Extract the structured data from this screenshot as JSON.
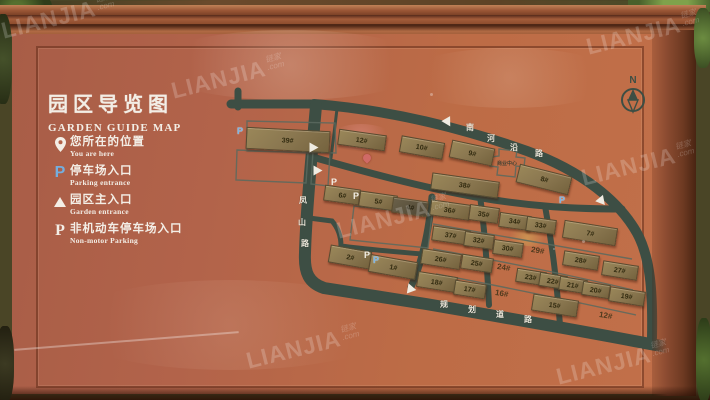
{
  "sign": {
    "title_cn": "园区导览图",
    "title_en": "GARDEN GUIDE MAP",
    "legend": [
      {
        "icon": "location-pin-icon",
        "label_cn": "您所在的位置",
        "label_en": "You are here"
      },
      {
        "icon": "parking-entrance-icon",
        "label_cn": "停车场入口",
        "label_en": "Parking entrance"
      },
      {
        "icon": "main-entrance-icon",
        "label_cn": "园区主入口",
        "label_en": "Garden entrance"
      },
      {
        "icon": "non-motor-parking-icon",
        "label_cn": "非机动车停车场入口",
        "label_en": "Non-motor Parking"
      }
    ],
    "compass": {
      "label": "N"
    }
  },
  "map": {
    "roads": [
      {
        "name": "南河沿路",
        "chars": [
          [
            466,
            122
          ],
          [
            487,
            133
          ],
          [
            510,
            142
          ],
          [
            535,
            148
          ]
        ]
      },
      {
        "name": "凤山路",
        "chars": [
          [
            299,
            195
          ],
          [
            298,
            217
          ],
          [
            301,
            238
          ]
        ]
      },
      {
        "name": "规划道路",
        "chars": [
          [
            440,
            299
          ],
          [
            468,
            304
          ],
          [
            496,
            309
          ],
          [
            524,
            314
          ]
        ]
      }
    ],
    "buildings": [
      {
        "label": "39#",
        "x": 287,
        "y": 139,
        "w": 82,
        "h": 20,
        "r": 3
      },
      {
        "label": "12#",
        "x": 361,
        "y": 139,
        "w": 46,
        "h": 14,
        "r": 8
      },
      {
        "label": "10#",
        "x": 421,
        "y": 146,
        "w": 42,
        "h": 15,
        "r": 10
      },
      {
        "label": "9#",
        "x": 471,
        "y": 152,
        "w": 42,
        "h": 16,
        "r": 12
      },
      {
        "label": "8#",
        "x": 543,
        "y": 178,
        "w": 52,
        "h": 17,
        "r": 14
      },
      {
        "label": "6#",
        "x": 341,
        "y": 194,
        "w": 34,
        "h": 14,
        "r": 8
      },
      {
        "label": "5#",
        "x": 377,
        "y": 200,
        "w": 36,
        "h": 14,
        "r": 8
      },
      {
        "label": "4#",
        "x": 409,
        "y": 206,
        "w": 34,
        "h": 14,
        "r": 8,
        "dark": true
      },
      {
        "label": "38#",
        "x": 464,
        "y": 184,
        "w": 66,
        "h": 15,
        "r": 8
      },
      {
        "label": "36#",
        "x": 449,
        "y": 209,
        "w": 38,
        "h": 14,
        "r": 8
      },
      {
        "label": "35#",
        "x": 483,
        "y": 213,
        "w": 28,
        "h": 14,
        "r": 8
      },
      {
        "label": "34#",
        "x": 514,
        "y": 220,
        "w": 30,
        "h": 13,
        "r": 8
      },
      {
        "label": "33#",
        "x": 540,
        "y": 224,
        "w": 28,
        "h": 13,
        "r": 8
      },
      {
        "label": "7#",
        "x": 589,
        "y": 232,
        "w": 52,
        "h": 16,
        "r": 9
      },
      {
        "label": "37#",
        "x": 450,
        "y": 234,
        "w": 36,
        "h": 13,
        "r": 8
      },
      {
        "label": "32#",
        "x": 478,
        "y": 239,
        "w": 28,
        "h": 13,
        "r": 8
      },
      {
        "label": "30#",
        "x": 507,
        "y": 247,
        "w": 28,
        "h": 13,
        "r": 8
      },
      {
        "label": "28#",
        "x": 580,
        "y": 259,
        "w": 34,
        "h": 13,
        "r": 9
      },
      {
        "label": "27#",
        "x": 619,
        "y": 269,
        "w": 34,
        "h": 13,
        "r": 9
      },
      {
        "label": "2#",
        "x": 349,
        "y": 256,
        "w": 40,
        "h": 16,
        "r": 10
      },
      {
        "label": "1#",
        "x": 392,
        "y": 266,
        "w": 46,
        "h": 16,
        "r": 10
      },
      {
        "label": "26#",
        "x": 440,
        "y": 258,
        "w": 38,
        "h": 14,
        "r": 9
      },
      {
        "label": "25#",
        "x": 476,
        "y": 262,
        "w": 30,
        "h": 13,
        "r": 9
      },
      {
        "label": "23#",
        "x": 530,
        "y": 276,
        "w": 28,
        "h": 12,
        "r": 9
      },
      {
        "label": "22#",
        "x": 552,
        "y": 280,
        "w": 26,
        "h": 12,
        "r": 9
      },
      {
        "label": "21#",
        "x": 572,
        "y": 284,
        "w": 26,
        "h": 12,
        "r": 9
      },
      {
        "label": "20#",
        "x": 595,
        "y": 289,
        "w": 26,
        "h": 12,
        "r": 9
      },
      {
        "label": "19#",
        "x": 626,
        "y": 295,
        "w": 34,
        "h": 13,
        "r": 9
      },
      {
        "label": "18#",
        "x": 436,
        "y": 281,
        "w": 38,
        "h": 14,
        "r": 9
      },
      {
        "label": "17#",
        "x": 469,
        "y": 288,
        "w": 30,
        "h": 13,
        "r": 9
      },
      {
        "label": "15#",
        "x": 554,
        "y": 304,
        "w": 44,
        "h": 15,
        "r": 9
      }
    ],
    "flat_labels": [
      {
        "label": "29#",
        "x": 540,
        "y": 251
      },
      {
        "label": "24#",
        "x": 506,
        "y": 268
      },
      {
        "label": "16#",
        "x": 504,
        "y": 294
      },
      {
        "label": "12#",
        "x": 608,
        "y": 316
      }
    ],
    "facility": {
      "label": "商业中心",
      "x": 508,
      "y": 163
    },
    "markers": [
      {
        "type": "parking-entrance",
        "x": 240,
        "y": 131
      },
      {
        "type": "non-motor-parking",
        "x": 334,
        "y": 182
      },
      {
        "type": "non-motor-parking",
        "x": 356,
        "y": 196
      },
      {
        "type": "non-motor-parking",
        "x": 367,
        "y": 255
      },
      {
        "type": "parking-entrance",
        "x": 376,
        "y": 260
      },
      {
        "type": "parking-entrance",
        "x": 562,
        "y": 200
      },
      {
        "type": "main-entrance",
        "x": 448,
        "y": 123,
        "rot": 150
      },
      {
        "type": "main-entrance",
        "x": 314,
        "y": 148,
        "rot": 90
      },
      {
        "type": "main-entrance",
        "x": 318,
        "y": 171,
        "rot": 90
      },
      {
        "type": "main-entrance",
        "x": 410,
        "y": 288,
        "rot": -20
      },
      {
        "type": "main-entrance",
        "x": 602,
        "y": 202,
        "rot": 140
      },
      {
        "type": "you-are-here",
        "x": 367,
        "y": 158
      }
    ]
  },
  "watermark": {
    "brand": "LIANJIA",
    "brand_cn": "链家",
    "suffix": ".com",
    "positions": [
      [
        55,
        18
      ],
      [
        225,
        78
      ],
      [
        640,
        34
      ],
      [
        390,
        218
      ],
      [
        635,
        165
      ],
      [
        300,
        348
      ],
      [
        610,
        364
      ]
    ]
  }
}
